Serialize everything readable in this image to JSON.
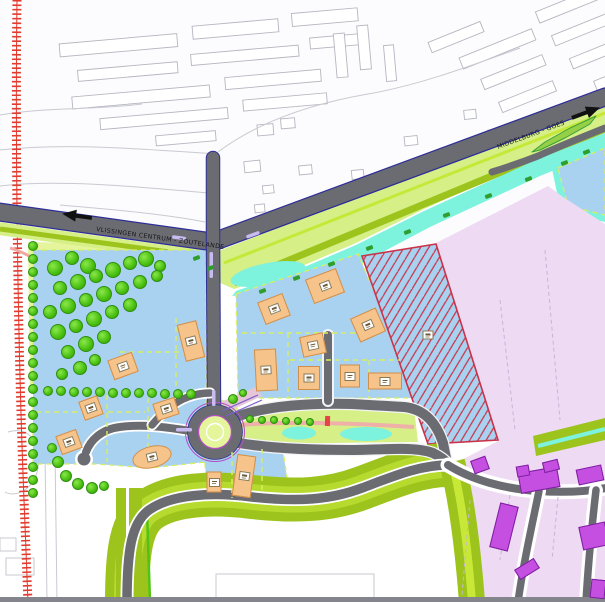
{
  "plan": {
    "kind": "urban development plan drawing",
    "labels": {
      "road_west_direction": "VLISSINGEN CENTRUM - ZOUTELANDE",
      "road_east_direction": "MIDDELBURG - GOES"
    },
    "colors": {
      "parcel_blue": "#a9d2f0",
      "district_pink": "#eedaf3",
      "building_orange": "#f6c38a",
      "building_orange_border": "#cf8f4a",
      "building_magenta": "#c44fe0",
      "building_magenta_border": "#7d1fa0",
      "water_cyan": "#7df2dd",
      "park_green": "#e4f59c",
      "verge_green": "#d6ef86",
      "olive_green": "#9cc41c",
      "bright_green": "#c6e838",
      "tree_green": "#4fc414",
      "road_gray": "#6b6c71",
      "railway_red": "#e23b2e",
      "hatch_red": "#c9344a",
      "path_salmon": "#eeb0a8",
      "marking_purple": "#7a5fd0",
      "median_lavender": "#c9bbf0"
    },
    "buildings": {
      "orange": [
        {
          "x": 123,
          "y": 366,
          "w": 26,
          "h": 21,
          "r": -20,
          "marker": true
        },
        {
          "x": 191,
          "y": 341,
          "w": 20,
          "h": 38,
          "r": -14,
          "marker": true
        },
        {
          "x": 91,
          "y": 408,
          "w": 20,
          "h": 20,
          "r": -20,
          "marker": true
        },
        {
          "x": 166,
          "y": 409,
          "w": 23,
          "h": 18,
          "r": -18,
          "marker": true
        },
        {
          "x": 69,
          "y": 442,
          "w": 22,
          "h": 20,
          "r": -20,
          "marker": true
        },
        {
          "x": 152,
          "y": 457,
          "w": 40,
          "h": 22,
          "r": -14,
          "shape": "ellipse",
          "marker": true
        },
        {
          "x": 274,
          "y": 309,
          "w": 27,
          "h": 24,
          "r": -21,
          "marker": true
        },
        {
          "x": 325,
          "y": 286,
          "w": 33,
          "h": 26,
          "r": -21,
          "marker": true
        },
        {
          "x": 368,
          "y": 325,
          "w": 28,
          "h": 26,
          "r": -24,
          "marker": true
        },
        {
          "x": 313,
          "y": 345,
          "w": 24,
          "h": 21,
          "r": -12,
          "marker": true
        },
        {
          "x": 266,
          "y": 370,
          "w": 22,
          "h": 42,
          "r": -3,
          "marker": true
        },
        {
          "x": 309,
          "y": 378,
          "w": 22,
          "h": 24,
          "r": 0,
          "marker": true
        },
        {
          "x": 350,
          "y": 376,
          "w": 20,
          "h": 23,
          "r": 0,
          "marker": true
        },
        {
          "x": 385,
          "y": 381,
          "w": 34,
          "h": 17,
          "r": 0,
          "marker": true
        },
        {
          "x": 214,
          "y": 482,
          "w": 15,
          "h": 21,
          "r": 0,
          "marker": true
        },
        {
          "x": 244,
          "y": 476,
          "w": 19,
          "h": 42,
          "r": 8,
          "marker": true
        }
      ],
      "magenta": [
        {
          "x": 480,
          "y": 465,
          "w": 16,
          "h": 14,
          "r": -20
        },
        {
          "x": 539,
          "y": 480,
          "w": 40,
          "h": 21,
          "r": -10
        },
        {
          "x": 523,
          "y": 471,
          "w": 13,
          "h": 11,
          "r": -10
        },
        {
          "x": 590,
          "y": 475,
          "w": 26,
          "h": 16,
          "r": -12
        },
        {
          "x": 504,
          "y": 527,
          "w": 19,
          "h": 46,
          "r": 14
        },
        {
          "x": 527,
          "y": 569,
          "w": 23,
          "h": 12,
          "r": -32
        },
        {
          "x": 594,
          "y": 536,
          "w": 27,
          "h": 24,
          "r": -12
        },
        {
          "x": 551,
          "y": 466,
          "w": 16,
          "h": 11,
          "r": -14
        },
        {
          "x": 598,
          "y": 589,
          "w": 15,
          "h": 19,
          "r": 6
        }
      ]
    },
    "hatched_parcel_marker": {
      "x": 428,
      "y": 335
    },
    "vegetation": {
      "park_trees": [
        [
          55,
          268,
          8
        ],
        [
          72,
          258,
          7
        ],
        [
          88,
          266,
          8
        ],
        [
          60,
          288,
          7
        ],
        [
          78,
          282,
          8
        ],
        [
          96,
          276,
          7
        ],
        [
          113,
          270,
          8
        ],
        [
          130,
          263,
          7
        ],
        [
          146,
          259,
          8
        ],
        [
          160,
          266,
          6
        ],
        [
          50,
          312,
          7
        ],
        [
          68,
          306,
          8
        ],
        [
          86,
          300,
          7
        ],
        [
          104,
          294,
          8
        ],
        [
          122,
          288,
          7
        ],
        [
          140,
          282,
          7
        ],
        [
          157,
          276,
          6
        ],
        [
          58,
          332,
          8
        ],
        [
          76,
          326,
          7
        ],
        [
          94,
          319,
          8
        ],
        [
          112,
          312,
          7
        ],
        [
          130,
          305,
          7
        ],
        [
          68,
          352,
          7
        ],
        [
          86,
          344,
          8
        ],
        [
          104,
          337,
          7
        ],
        [
          80,
          368,
          7
        ],
        [
          95,
          360,
          6
        ],
        [
          62,
          374,
          6
        ]
      ],
      "bulb_trees": [
        [
          58,
          462,
          6
        ],
        [
          66,
          476,
          6
        ],
        [
          78,
          484,
          6
        ],
        [
          92,
          488,
          6
        ],
        [
          104,
          486,
          5
        ],
        [
          52,
          448,
          5
        ],
        [
          233,
          399,
          5
        ],
        [
          243,
          393,
          4
        ]
      ],
      "rows": [
        {
          "x0": 33,
          "y0": 246,
          "dx": 0,
          "dy": 13,
          "count": 20,
          "r": 5
        },
        {
          "x0": 48,
          "y0": 391,
          "dx": 13,
          "dy": 0.3,
          "count": 12,
          "r": 5
        },
        {
          "x0": 250,
          "y0": 419,
          "dx": 12,
          "dy": 0.5,
          "count": 6,
          "r": 4
        }
      ],
      "bushes": [
        [
          262,
          291
        ],
        [
          296,
          278
        ],
        [
          331,
          264
        ],
        [
          369,
          248
        ],
        [
          407,
          232
        ],
        [
          446,
          215
        ],
        [
          488,
          196
        ],
        [
          528,
          179
        ],
        [
          210,
          268
        ],
        [
          196,
          258
        ],
        [
          564,
          163
        ],
        [
          586,
          152
        ]
      ]
    }
  }
}
